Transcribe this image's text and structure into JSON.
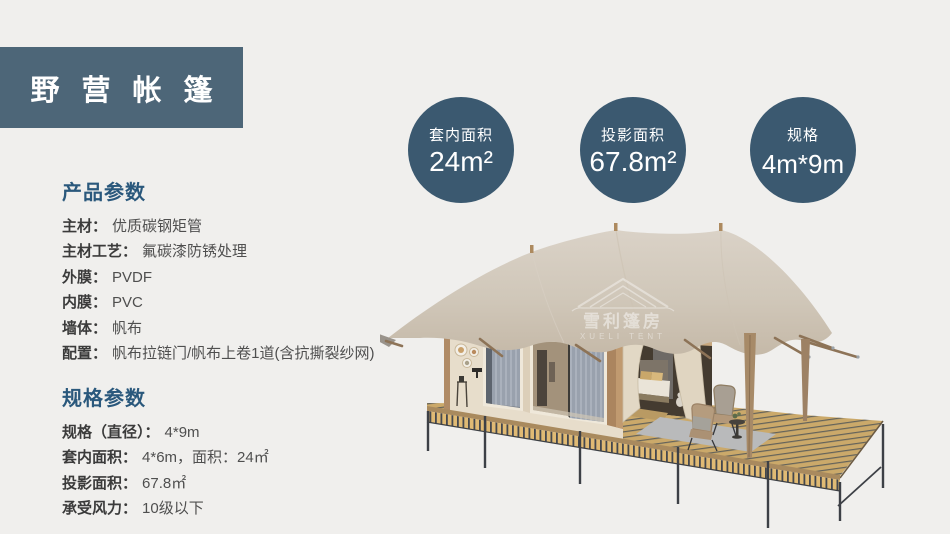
{
  "header": {
    "title": "野营帐篷"
  },
  "badges": [
    {
      "label": "套内面积",
      "value": "24m²"
    },
    {
      "label": "投影面积",
      "value": "67.8m²"
    },
    {
      "label": "规格",
      "value": "4m*9m"
    }
  ],
  "product_params": {
    "heading": "产品参数",
    "items": [
      {
        "label": "主材：",
        "value": "优质碳钢矩管"
      },
      {
        "label": "主材工艺：",
        "value": "氟碳漆防锈处理"
      },
      {
        "label": "外膜：",
        "value": "PVDF"
      },
      {
        "label": "内膜：",
        "value": "PVC"
      },
      {
        "label": "墙体：",
        "value": "帆布"
      },
      {
        "label": "配置：",
        "value": "帆布拉链门/帆布上卷1道(含抗撕裂纱网)"
      }
    ]
  },
  "spec_params": {
    "heading": "规格参数",
    "items": [
      {
        "label": "规格（直径）：",
        "value": "4*9m"
      },
      {
        "label": "套内面积：",
        "value": "4*6m，面积：24㎡"
      },
      {
        "label": "投影面积：",
        "value": "67.8㎡"
      },
      {
        "label": "承受风力：",
        "value": "10级以下"
      }
    ]
  },
  "watermark": {
    "brand": "雪利篷房",
    "brand_en": "XUELI TENT"
  },
  "colors": {
    "background": "#f0efed",
    "title_box": "#4d6678",
    "badge": "#3b5970",
    "heading": "#2a587c",
    "label_text": "#3b3b3b",
    "value_text": "#4f4f4f",
    "canopy": "#d0c7b9",
    "cabin_wall": "#e7ddcb",
    "deck_plank": "#cba96a",
    "wood_pole": "#a78a68"
  }
}
